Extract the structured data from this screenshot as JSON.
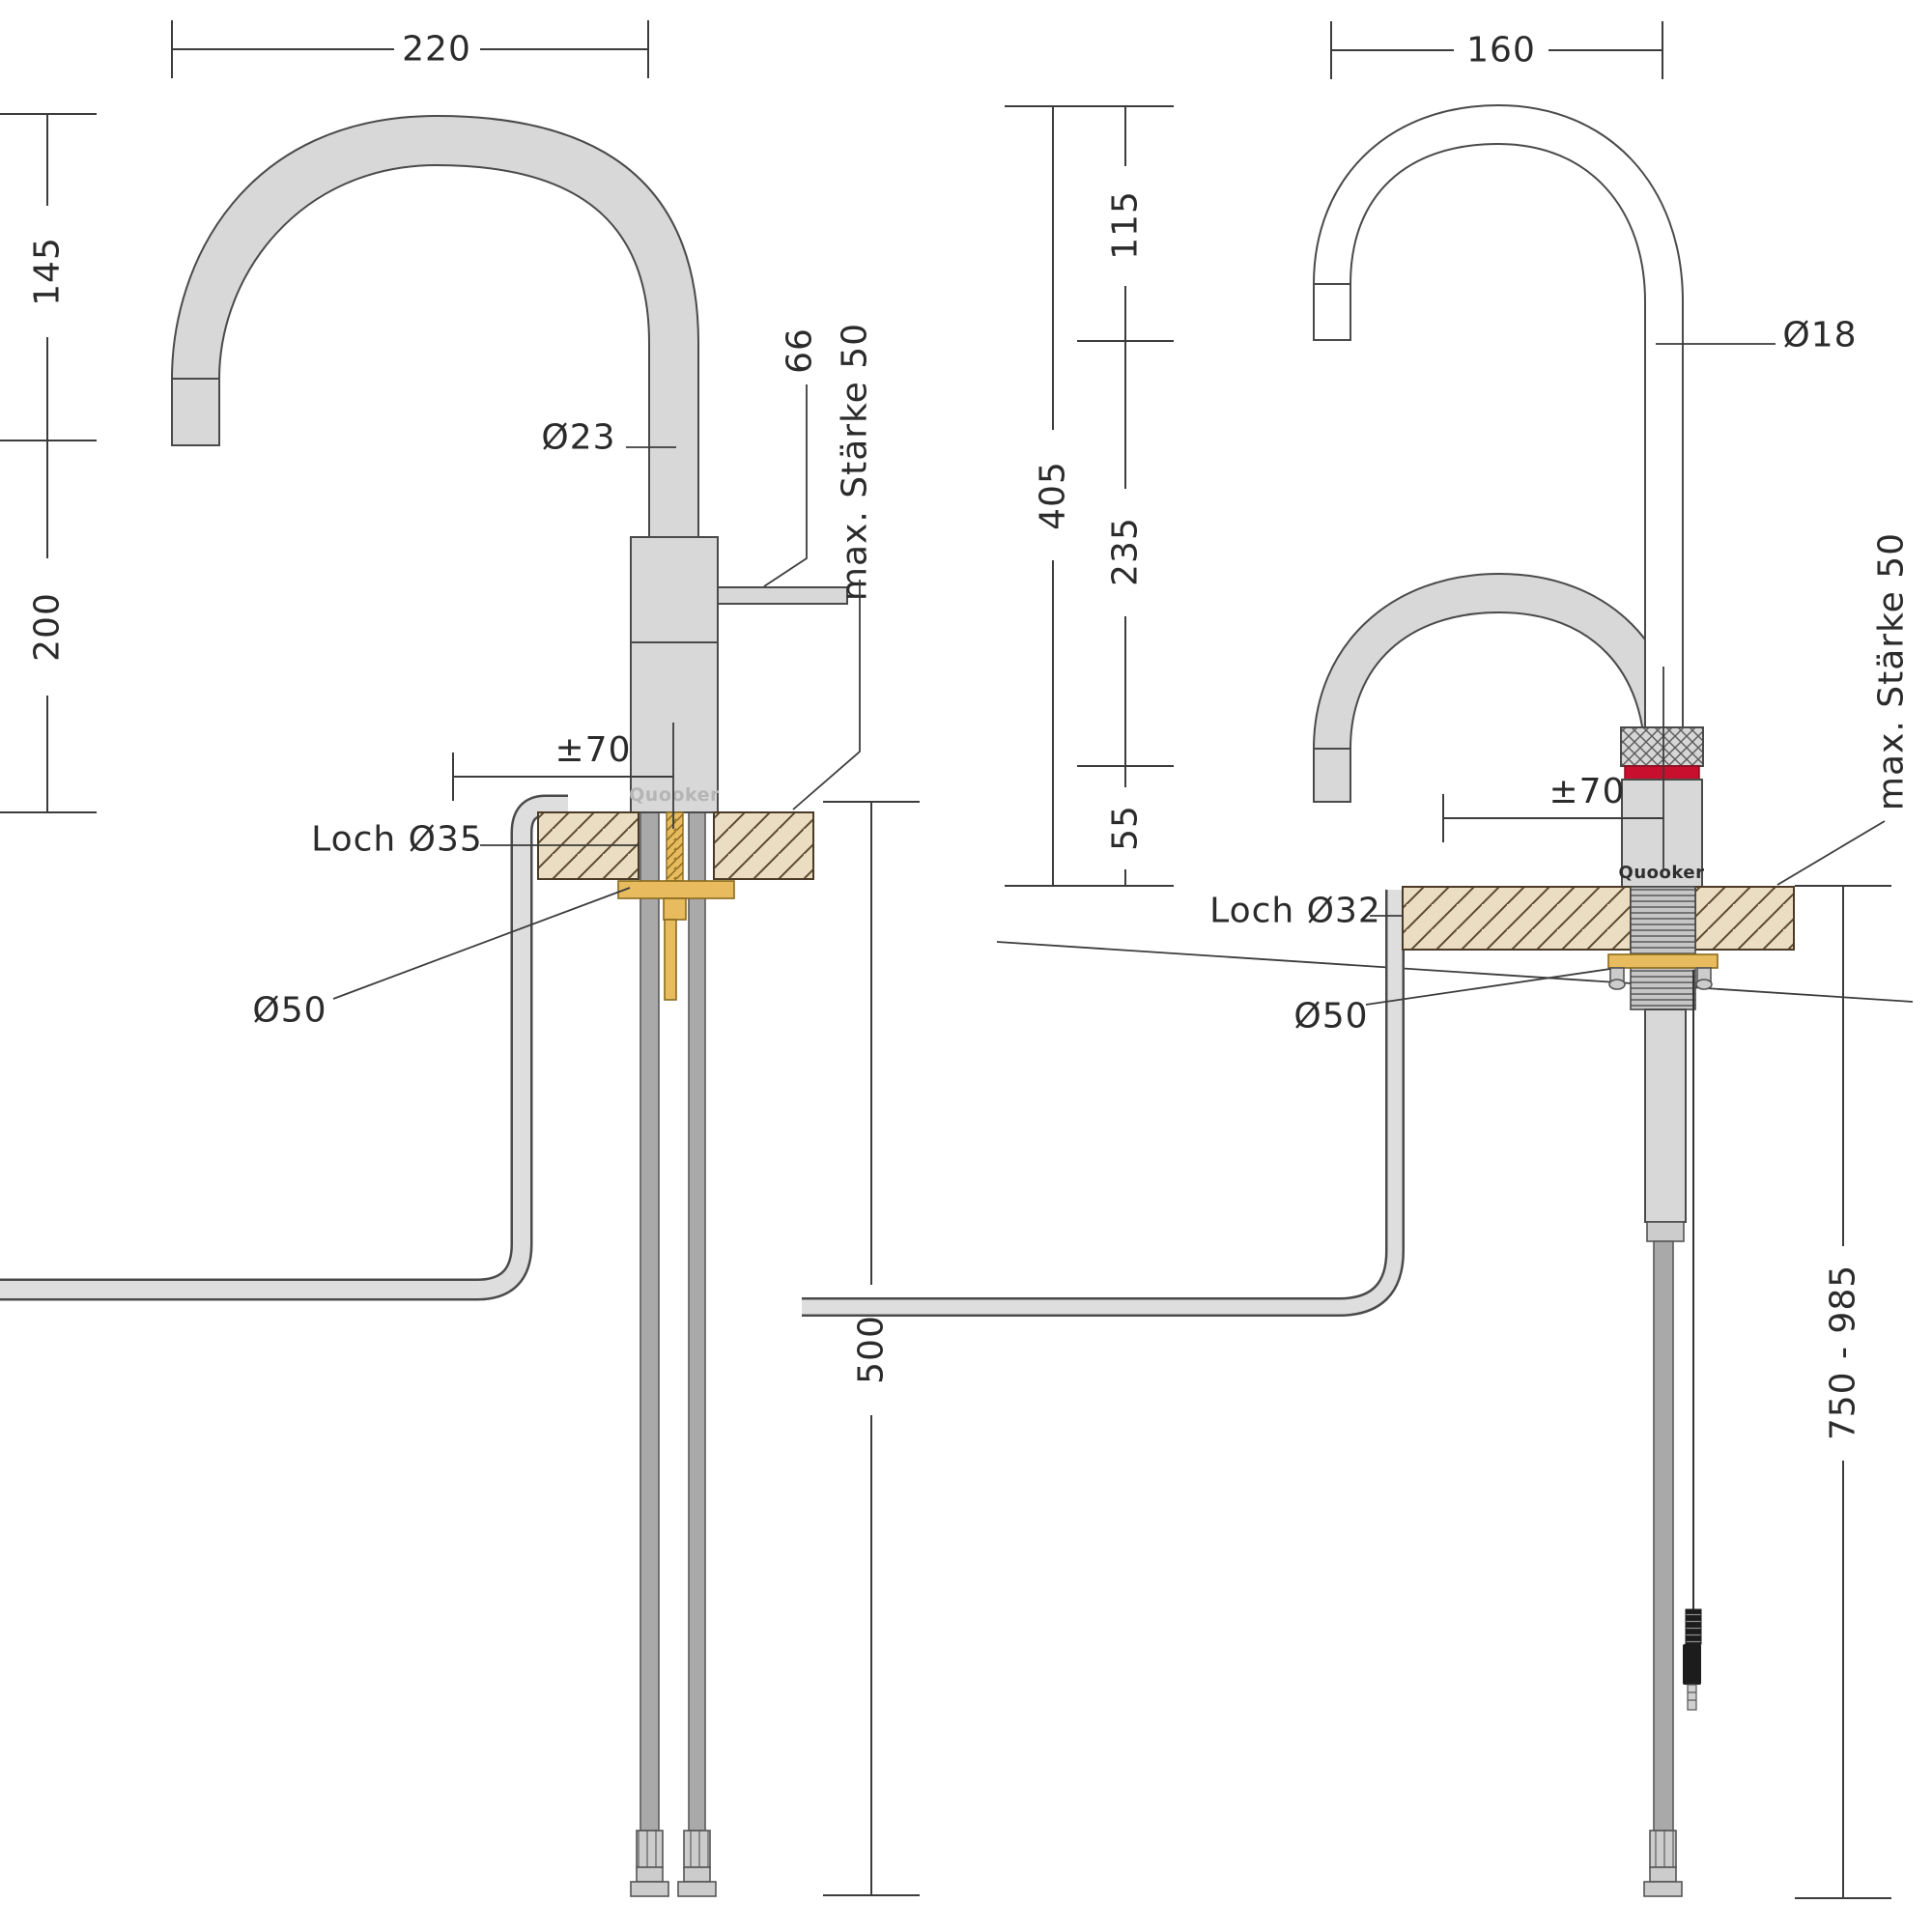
{
  "left_diagram": {
    "logo": "Quooker",
    "dims": {
      "top_width": "220",
      "upper_height": "145",
      "lower_height": "200",
      "spout_diameter": "Ø23",
      "handle_length": "66",
      "max_thickness": "max. Stärke 50",
      "swivel_offset": "±70",
      "hole": "Loch Ø35",
      "flange_diameter": "Ø50",
      "below_counter": "500"
    }
  },
  "right_diagram": {
    "logo": "Quooker",
    "dims": {
      "top_width": "160",
      "upper_height": "115",
      "mid_height": "235",
      "lower_height": "55",
      "total_height": "405",
      "spout_diameter": "Ø18",
      "max_thickness": "max. Stärke 50",
      "swivel_offset": "±70",
      "hole": "Loch Ø32",
      "flange_diameter": "Ø50",
      "below_counter": "750 - 985"
    }
  },
  "colors": {
    "metal_gray": "#d8d8d8",
    "hose_gray": "#a9a9a9",
    "counter_tan": "#eaddc2",
    "brass_gold": "#e7bb5e",
    "accent_red": "#c8102e"
  }
}
